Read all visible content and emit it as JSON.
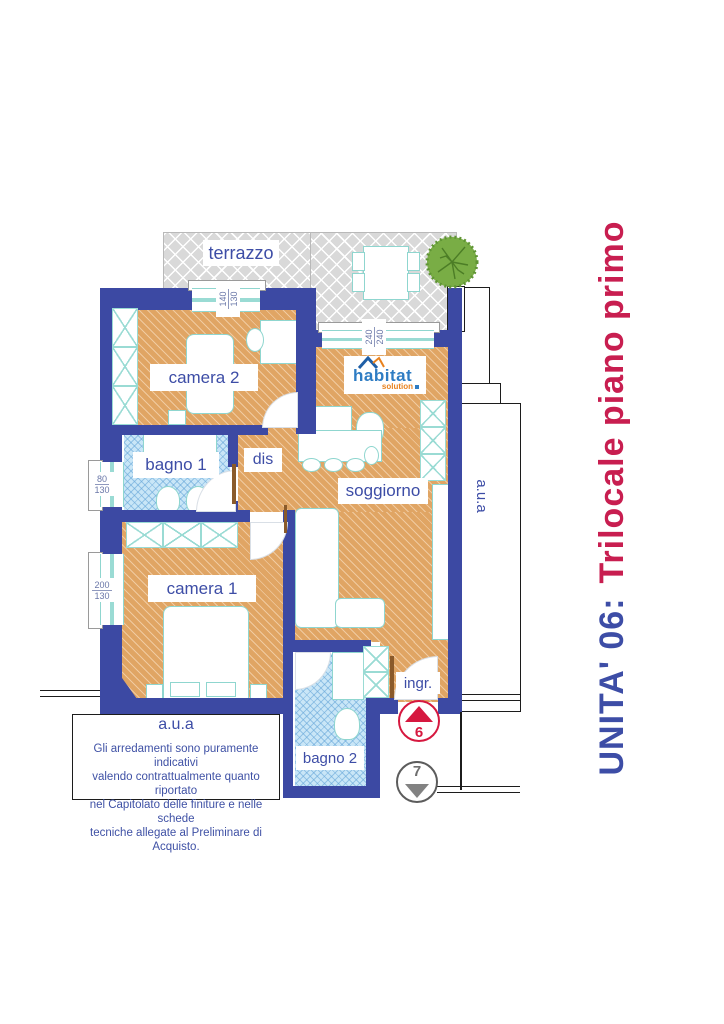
{
  "title": {
    "unit": "UNITA' 06:",
    "description": "Trilocale piano primo"
  },
  "rooms": {
    "terrazzo": "terrazzo",
    "camera2": "camera 2",
    "bagno1": "bagno 1",
    "dis": "dis",
    "soggiorno": "soggiorno",
    "camera1": "camera 1",
    "bagno2": "bagno 2",
    "ingresso": "ingr."
  },
  "logo": {
    "brand": "habitat",
    "tagline": "solution"
  },
  "windows": {
    "camera2": {
      "width": "140",
      "height": "130"
    },
    "soggiorno": {
      "width": "240",
      "height": "240"
    },
    "bagno1": {
      "width": "80",
      "height": "130"
    },
    "camera1": {
      "width": "200",
      "height": "130"
    }
  },
  "areas": {
    "right": "a.u.a",
    "bottom": "a.u.a"
  },
  "markers": {
    "entrance": "6",
    "secondary": "7"
  },
  "disclaimer": {
    "line1": "Gli arredamenti sono puramente indicativi",
    "line2": "valendo contrattualmente quanto riportato",
    "line3": "nel Capitolato delle finiture e nelle schede",
    "line4": "tecniche allegate al Preliminare di Acquisto."
  },
  "colors": {
    "wall": "#3c49a3",
    "floor": "#e0a564",
    "bath": "#c9e6f7",
    "terrace": "#d9d9d9",
    "accent_blue": "#3d4da6",
    "accent_red": "#c81e50",
    "marker_red": "#d6183f",
    "tree_green": "#79ad45",
    "furniture_line": "#8fd6cf"
  }
}
